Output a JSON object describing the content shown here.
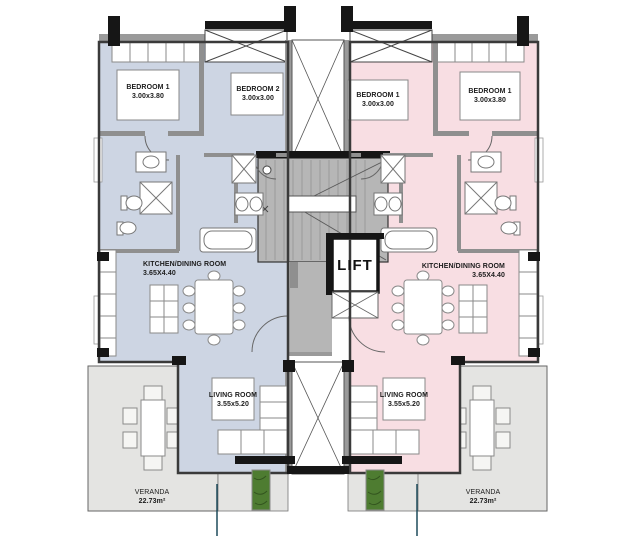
{
  "left_apartment": {
    "bedroom1": {
      "name": "BEDROOM 1",
      "dims": "3.00x3.80"
    },
    "bedroom2": {
      "name": "BEDROOM 2",
      "dims": "3.00x3.00"
    },
    "kitchen_dining": {
      "name": "KITCHEN/DINING ROOM",
      "dims": "3.65X4.40"
    },
    "living_room": {
      "name": "LIVING ROOM",
      "dims": "3.55x5.20"
    },
    "veranda": {
      "name": "VERANDA",
      "area": "22.73m²"
    }
  },
  "right_apartment": {
    "bedroom1": {
      "name": "BEDROOM 1",
      "dims": "3.00x3.00"
    },
    "bedroom2": {
      "name": "BEDROOM 1",
      "dims": "3.00x3.80"
    },
    "kitchen_dining": {
      "name": "KITCHEN/DINING ROOM",
      "dims": "3.65X4.40"
    },
    "living_room": {
      "name": "LIVING ROOM",
      "dims": "3.55x5.20"
    },
    "veranda": {
      "name": "VERANDA",
      "area": "22.73m²"
    }
  },
  "core": {
    "lift_label": "LIFT"
  },
  "colors": {
    "left_floor": "#cdd5e3",
    "right_floor": "#f8dee3",
    "veranda": "#e4e4e2",
    "core_gray": "#b6b6b6",
    "wall_dark": "#161616",
    "wall_gray": "#9a9a9a",
    "planter_green": "#4e7c31",
    "leader_line": "#1d4a5a",
    "fixture_white": "#ffffff"
  }
}
